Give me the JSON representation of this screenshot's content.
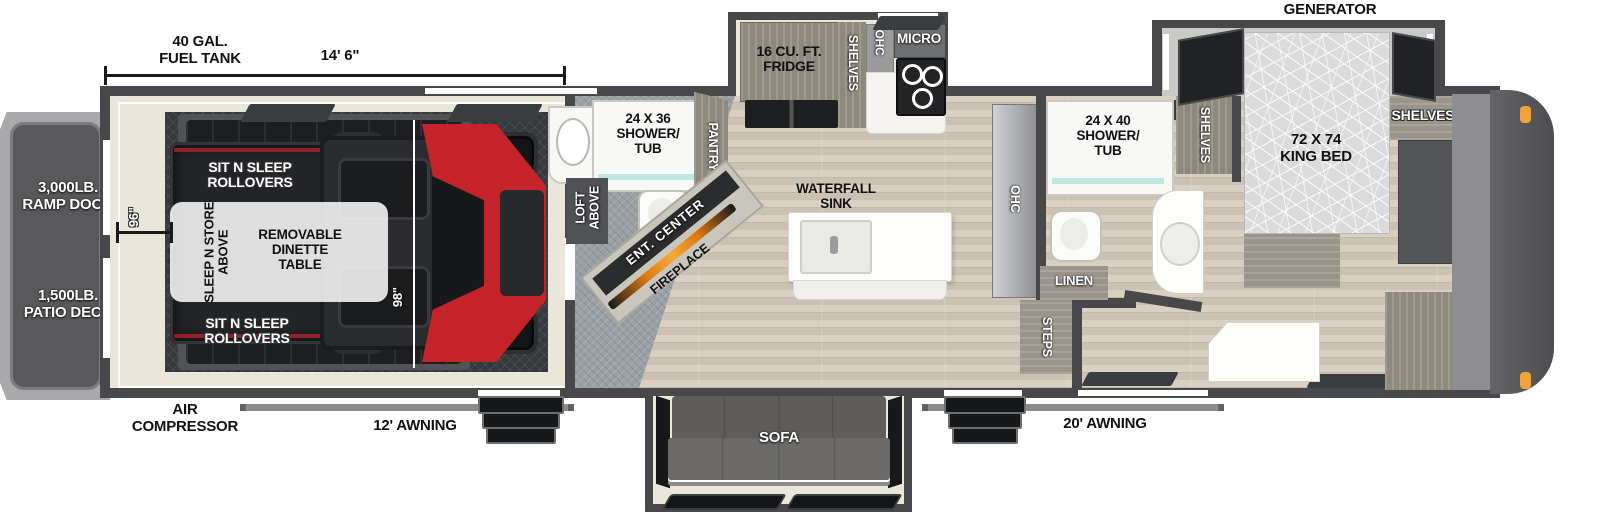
{
  "colors": {
    "wall": "#48484a",
    "floor_cream": "#eae7da",
    "floor_wood": "#d6ccbd",
    "garage_plate": "#35383c",
    "accent_red": "#c4232a",
    "fireplace_orange": "#e07b10",
    "marker_light": "#f0a23a",
    "shower_glass": "#bfe8e2"
  },
  "exterior": {
    "fuel_tank": "40 GAL.\nFUEL TANK",
    "dim_length": "14' 6\"",
    "generator_prep": "GENERATOR\nPREP",
    "ramp_door": "3,000LB.\nRAMP DOOR",
    "patio_deck": "1,500LB.\nPATIO DECK",
    "air_compressor": "AIR\nCOMPRESSOR",
    "awning_left": "12' AWNING",
    "awning_right": "20' AWNING"
  },
  "garage": {
    "rollovers_top": "SIT N SLEEP\nROLLOVERS",
    "rollovers_bottom": "SIT N SLEEP\nROLLOVERS",
    "sleep_n_store": "SLEEP N STORE\nABOVE",
    "dinette": "REMOVABLE\nDINETTE\nTABLE",
    "dim_width": "96\"",
    "dim_interior": "98\"",
    "loft": "LOFT\nABOVE"
  },
  "half_bath": {
    "shower": "24 X 36\nSHOWER/\nTUB",
    "pantry": "PANTRY"
  },
  "kitchen": {
    "fridge": "16 CU. FT.\nFRIDGE",
    "shelves": "SHELVES",
    "ohc": "OHC",
    "micro": "MICRO"
  },
  "living": {
    "ent_center": "ENT. CENTER",
    "fireplace": "FIREPLACE",
    "waterfall_sink": "WATERFALL\nSINK",
    "ohc": "OHC",
    "sofa": "SOFA"
  },
  "bathroom": {
    "shower": "24 X 40\nSHOWER/\nTUB",
    "shelves": "SHELVES",
    "linen": "LINEN",
    "steps": "STEPS"
  },
  "bedroom": {
    "bed": "72 X 74\nKING BED",
    "shelves": "SHELVES",
    "ward": "WARD",
    "washer_dryer": "WASHER/\nDRYER\nPREP"
  }
}
